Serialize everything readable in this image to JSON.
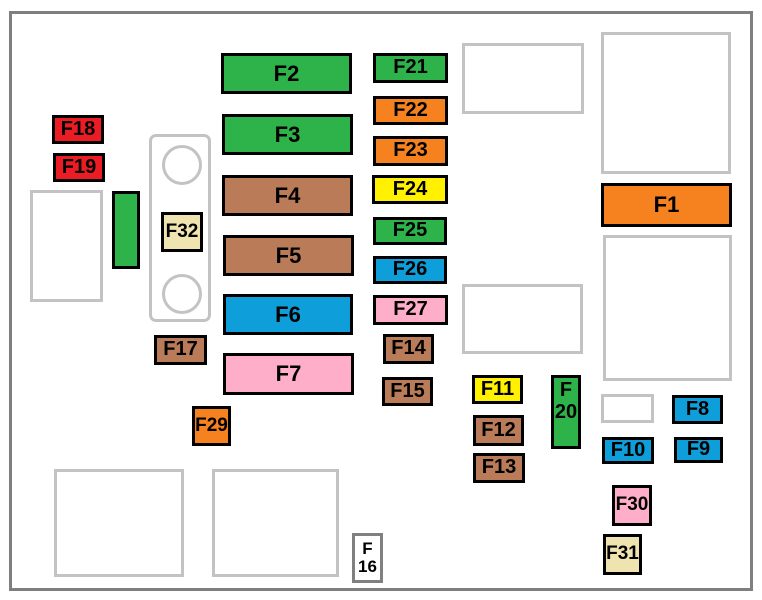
{
  "diagram": {
    "name": "engine-compartment-fuse-box-diagram",
    "palette": {
      "green": "#2db34a",
      "orange": "#f5821f",
      "red": "#ec1c24",
      "yellow": "#fff100",
      "blue": "#0e9fda",
      "brown": "#b97b58",
      "pink": "#ffaec9",
      "tan": "#efe4b0",
      "white": "#ffffff",
      "fuse_border": "#000000",
      "placeholder_border": "#c3c3c3",
      "f16_border": "#808080",
      "frame_border": "#7f7f7f",
      "label_color": "#000000"
    },
    "frame": {
      "x": 9,
      "y": 11,
      "w": 744,
      "h": 580
    },
    "connector": {
      "rect": {
        "x": 149,
        "y": 134,
        "w": 62,
        "h": 188
      },
      "circles": [
        {
          "name": "connector-circle-top",
          "x": 162,
          "y": 145,
          "d": 40
        },
        {
          "name": "connector-circle-bottom",
          "x": 162,
          "y": 274,
          "d": 40
        }
      ]
    },
    "fuses": [
      {
        "id": "F1",
        "lines": [
          "F1"
        ],
        "x": 601,
        "y": 183,
        "w": 131,
        "h": 44,
        "color": "orange",
        "fs": 22
      },
      {
        "id": "F2",
        "lines": [
          "F2"
        ],
        "x": 221,
        "y": 53,
        "w": 131,
        "h": 41,
        "color": "green",
        "fs": 22
      },
      {
        "id": "F3",
        "lines": [
          "F3"
        ],
        "x": 222,
        "y": 114,
        "w": 131,
        "h": 41,
        "color": "green",
        "fs": 22
      },
      {
        "id": "F4",
        "lines": [
          "F4"
        ],
        "x": 222,
        "y": 175,
        "w": 131,
        "h": 41,
        "color": "brown",
        "fs": 22
      },
      {
        "id": "F5",
        "lines": [
          "F5"
        ],
        "x": 223,
        "y": 235,
        "w": 131,
        "h": 41,
        "color": "brown",
        "fs": 22
      },
      {
        "id": "F6",
        "lines": [
          "F6"
        ],
        "x": 223,
        "y": 294,
        "w": 130,
        "h": 41,
        "color": "blue",
        "fs": 22
      },
      {
        "id": "F7",
        "lines": [
          "F7"
        ],
        "x": 223,
        "y": 353,
        "w": 131,
        "h": 42,
        "color": "pink",
        "fs": 22
      },
      {
        "id": "F8",
        "lines": [
          "F8"
        ],
        "x": 672,
        "y": 395,
        "w": 51,
        "h": 29,
        "color": "blue",
        "fs": 20
      },
      {
        "id": "F9",
        "lines": [
          "F9"
        ],
        "x": 674,
        "y": 437,
        "w": 49,
        "h": 26,
        "color": "blue",
        "fs": 20
      },
      {
        "id": "F10",
        "lines": [
          "F10"
        ],
        "x": 602,
        "y": 437,
        "w": 52,
        "h": 27,
        "color": "blue",
        "fs": 20
      },
      {
        "id": "F11",
        "lines": [
          "F11"
        ],
        "x": 472,
        "y": 375,
        "w": 51,
        "h": 29,
        "color": "yellow",
        "fs": 20
      },
      {
        "id": "F12",
        "lines": [
          "F12"
        ],
        "x": 473,
        "y": 415,
        "w": 51,
        "h": 31,
        "color": "brown",
        "fs": 20
      },
      {
        "id": "F13",
        "lines": [
          "F13"
        ],
        "x": 473,
        "y": 453,
        "w": 52,
        "h": 30,
        "color": "brown",
        "fs": 20
      },
      {
        "id": "F14",
        "lines": [
          "F14"
        ],
        "x": 383,
        "y": 334,
        "w": 51,
        "h": 30,
        "color": "brown",
        "fs": 20
      },
      {
        "id": "F15",
        "lines": [
          "F15"
        ],
        "x": 382,
        "y": 377,
        "w": 51,
        "h": 29,
        "color": "brown",
        "fs": 20
      },
      {
        "id": "F16",
        "lines": [
          "F",
          "16"
        ],
        "x": 352,
        "y": 533,
        "w": 31,
        "h": 50,
        "color": "white",
        "fs": 17,
        "border": "f16_border"
      },
      {
        "id": "F17",
        "lines": [
          "F17"
        ],
        "x": 154,
        "y": 335,
        "w": 53,
        "h": 30,
        "color": "brown",
        "fs": 20
      },
      {
        "id": "F18",
        "lines": [
          "F18"
        ],
        "x": 52,
        "y": 115,
        "w": 52,
        "h": 29,
        "color": "red",
        "fs": 20
      },
      {
        "id": "F19",
        "lines": [
          "F19"
        ],
        "x": 53,
        "y": 153,
        "w": 52,
        "h": 29,
        "color": "red",
        "fs": 20
      },
      {
        "id": "F20",
        "lines": [
          "F",
          "20"
        ],
        "x": 551,
        "y": 375,
        "w": 30,
        "h": 74,
        "color": "green",
        "fs": 20,
        "align_top": true
      },
      {
        "id": "F21",
        "lines": [
          "F21"
        ],
        "x": 373,
        "y": 53,
        "w": 75,
        "h": 30,
        "color": "green",
        "fs": 20
      },
      {
        "id": "F22",
        "lines": [
          "F22"
        ],
        "x": 373,
        "y": 96,
        "w": 75,
        "h": 29,
        "color": "orange",
        "fs": 20
      },
      {
        "id": "F23",
        "lines": [
          "F23"
        ],
        "x": 373,
        "y": 136,
        "w": 75,
        "h": 30,
        "color": "orange",
        "fs": 20
      },
      {
        "id": "F24",
        "lines": [
          "F24"
        ],
        "x": 372,
        "y": 175,
        "w": 76,
        "h": 29,
        "color": "yellow",
        "fs": 20
      },
      {
        "id": "F25",
        "lines": [
          "F25"
        ],
        "x": 373,
        "y": 217,
        "w": 74,
        "h": 28,
        "color": "green",
        "fs": 20
      },
      {
        "id": "F26",
        "lines": [
          "F26"
        ],
        "x": 373,
        "y": 256,
        "w": 74,
        "h": 28,
        "color": "blue",
        "fs": 20
      },
      {
        "id": "F27",
        "lines": [
          "F27"
        ],
        "x": 373,
        "y": 295,
        "w": 75,
        "h": 30,
        "color": "pink",
        "fs": 20
      },
      {
        "id": "F29",
        "lines": [
          "F29"
        ],
        "x": 192,
        "y": 406,
        "w": 39,
        "h": 40,
        "color": "orange",
        "fs": 19
      },
      {
        "id": "F30",
        "lines": [
          "F30"
        ],
        "x": 612,
        "y": 485,
        "w": 40,
        "h": 41,
        "color": "pink",
        "fs": 19
      },
      {
        "id": "F31",
        "lines": [
          "F31"
        ],
        "x": 603,
        "y": 534,
        "w": 39,
        "h": 41,
        "color": "tan",
        "fs": 19
      },
      {
        "id": "F32",
        "lines": [
          "F32"
        ],
        "x": 161,
        "y": 212,
        "w": 42,
        "h": 40,
        "color": "tan",
        "fs": 19
      },
      {
        "id": "relay-bar",
        "lines": [],
        "x": 112,
        "y": 191,
        "w": 28,
        "h": 78,
        "color": "green",
        "fs": 20
      }
    ],
    "placeholders": [
      {
        "name": "placeholder-left",
        "x": 30,
        "y": 190,
        "w": 73,
        "h": 112
      },
      {
        "name": "placeholder-top-middle",
        "x": 462,
        "y": 43,
        "w": 122,
        "h": 71
      },
      {
        "name": "placeholder-top-right",
        "x": 601,
        "y": 32,
        "w": 130,
        "h": 142
      },
      {
        "name": "placeholder-right-middle",
        "x": 603,
        "y": 235,
        "w": 129,
        "h": 146
      },
      {
        "name": "placeholder-middle",
        "x": 462,
        "y": 284,
        "w": 121,
        "h": 70
      },
      {
        "name": "placeholder-small-right",
        "x": 601,
        "y": 394,
        "w": 53,
        "h": 29
      },
      {
        "name": "placeholder-bottom-left",
        "x": 54,
        "y": 469,
        "w": 130,
        "h": 108
      },
      {
        "name": "placeholder-bottom-mid",
        "x": 212,
        "y": 469,
        "w": 127,
        "h": 108
      }
    ]
  }
}
